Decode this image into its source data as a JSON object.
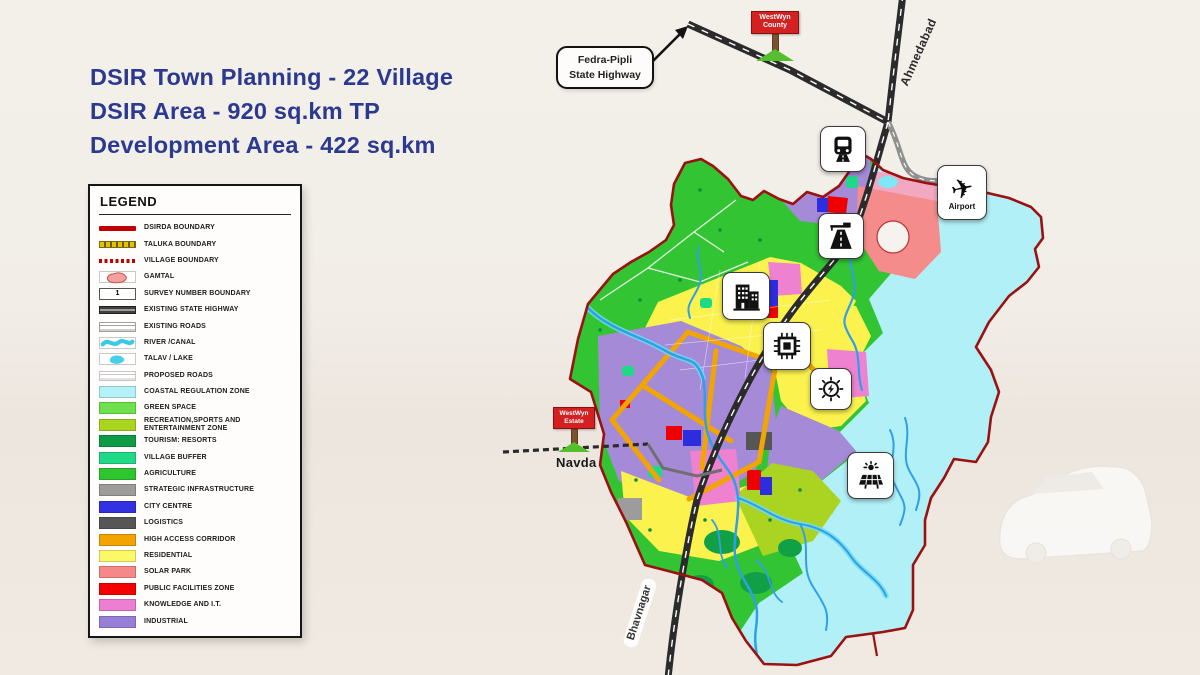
{
  "title": {
    "color": "#2b3990",
    "lines": [
      "DSIR Town Planning - 22 Village",
      "DSIR Area - 920 sq.km TP",
      "Development Area - 422 sq.km"
    ]
  },
  "legend": {
    "heading": "LEGEND",
    "items": [
      {
        "label": "DSIRDA BOUNDARY",
        "swatch": "line-thick",
        "color": "#c00000"
      },
      {
        "label": "TALUKA BOUNDARY",
        "swatch": "dash-square",
        "color": "#e2c400"
      },
      {
        "label": "VILLAGE BOUNDARY",
        "swatch": "dash-fine",
        "color": "#c00000"
      },
      {
        "label": "GAMTAL",
        "swatch": "blob",
        "color": "#f2a0a0"
      },
      {
        "label": "SURVEY NUMBER BOUNDARY",
        "swatch": "survey-box",
        "color": "#ffffff",
        "text": "1"
      },
      {
        "label": "EXISTING STATE HIGHWAY",
        "swatch": "highway",
        "color": "#4a4a4a"
      },
      {
        "label": "EXISTING ROADS",
        "swatch": "roads",
        "color": "#9f9f9f"
      },
      {
        "label": "RIVER /CANAL",
        "swatch": "wave",
        "color": "#3cc8e8"
      },
      {
        "label": "TALAV / LAKE",
        "swatch": "lake",
        "color": "#49cfe8"
      },
      {
        "label": "PROPOSED ROADS",
        "swatch": "roads",
        "color": "#c6c6c6"
      },
      {
        "label": "COASTAL REGULATION ZONE",
        "swatch": "fill",
        "color": "#b5f1f8"
      },
      {
        "label": "GREEN SPACE",
        "swatch": "fill",
        "color": "#6ee24e"
      },
      {
        "label": "RECREATION,SPORTS AND ENTERTAINMENT ZONE",
        "swatch": "fill",
        "color": "#a9d420"
      },
      {
        "label": "TOURISM: RESORTS",
        "swatch": "fill",
        "color": "#0d9b45"
      },
      {
        "label": "VILLAGE BUFFER",
        "swatch": "fill",
        "color": "#1fd987"
      },
      {
        "label": "AGRICULTURE",
        "swatch": "fill",
        "color": "#2fc52f"
      },
      {
        "label": "STRATEGIC INFRASTRUCTURE",
        "swatch": "fill",
        "color": "#9c9c9c"
      },
      {
        "label": "CITY CENTRE",
        "swatch": "fill",
        "color": "#3232e0"
      },
      {
        "label": "LOGISTICS",
        "swatch": "fill",
        "color": "#565656"
      },
      {
        "label": "HIGH ACCESS CORRIDOR",
        "swatch": "fill",
        "color": "#f3a402"
      },
      {
        "label": "RESIDENTIAL",
        "swatch": "fill",
        "color": "#fbf968"
      },
      {
        "label": "SOLAR PARK",
        "swatch": "fill",
        "color": "#f78888"
      },
      {
        "label": "PUBLIC FACILITIES ZONE",
        "swatch": "fill",
        "color": "#f40000"
      },
      {
        "label": "KNOWLEDGE AND I.T.",
        "swatch": "fill",
        "color": "#ec7fd2"
      },
      {
        "label": "INDUSTRIAL",
        "swatch": "fill",
        "color": "#977fd7"
      }
    ]
  },
  "map": {
    "callout": {
      "lines": [
        "Fedra-Pipli",
        "State Highway"
      ]
    },
    "signs": {
      "county": {
        "lines": [
          "WestWyn",
          "County"
        ]
      },
      "estate": {
        "lines": [
          "WestWyn",
          "Estate"
        ]
      }
    },
    "labels": {
      "ahmedabad": "Ahmedabad",
      "bhavnagar": "Bhavnagar",
      "navda": "Navda",
      "airport": "Airport"
    },
    "icons": [
      {
        "name": "train-icon"
      },
      {
        "name": "highway-icon"
      },
      {
        "name": "city-buildings-icon"
      },
      {
        "name": "semiconductor-chip-icon"
      },
      {
        "name": "power-energy-icon"
      },
      {
        "name": "solar-farm-icon"
      },
      {
        "name": "airport-icon"
      }
    ],
    "zone_colors": {
      "boundary": "#9b1111",
      "coastal": "#b2f0f8",
      "agriculture": "#33c433",
      "residential": "#fbf24e",
      "industrial": "#a58ad8",
      "recreation": "#abd321",
      "tourism": "#12a047",
      "buffer": "#1fd987",
      "knowledge": "#ee82d0",
      "solarpark": "#f58c8c",
      "public": "#ee0000",
      "city": "#2d2de0",
      "corridor": "#f2a402",
      "strategic": "#9c9c9c",
      "logistics": "#565656",
      "river": "#2fa0e6",
      "riverlight": "#6fdcf2",
      "road": "#2b2b2b",
      "roadgray": "#8f8f8f"
    }
  }
}
